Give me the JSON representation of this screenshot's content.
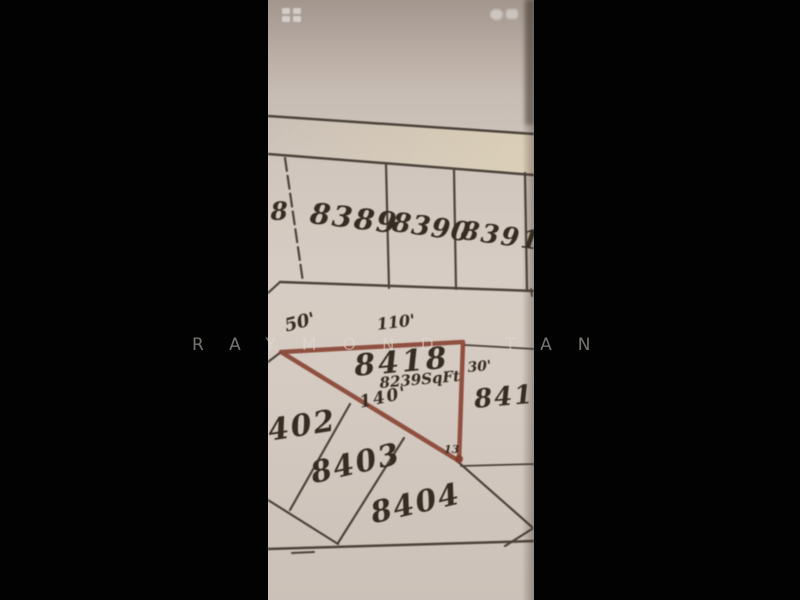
{
  "watermark": {
    "text": "RAYMOND TAN"
  },
  "status_bar": {
    "left_icons": [
      "notification-icon",
      "notification-icon"
    ],
    "right_icons": [
      "signal-icon",
      "battery-icon"
    ]
  },
  "map": {
    "type": "cadastral plat map photo, letterboxed phone screenshot",
    "lot_labels": {
      "partial_left": "8",
      "l8389": "8389",
      "l8390": "8390",
      "l8391": "8391",
      "l8418": "8418",
      "l8419": "8419",
      "l8402": "402",
      "l8403": "8403",
      "l8404": "8404"
    },
    "measurements": {
      "left_side": "50'",
      "top_side": "110'",
      "right_side": "30'",
      "bottom_side": "140'",
      "area": "8239SqFt",
      "corner_point": "13"
    },
    "colors": {
      "highlight_outline": "#8a4536",
      "map_lines": "#3b322a",
      "paper": "#d3c9c0",
      "letterbox": "#020202"
    }
  }
}
